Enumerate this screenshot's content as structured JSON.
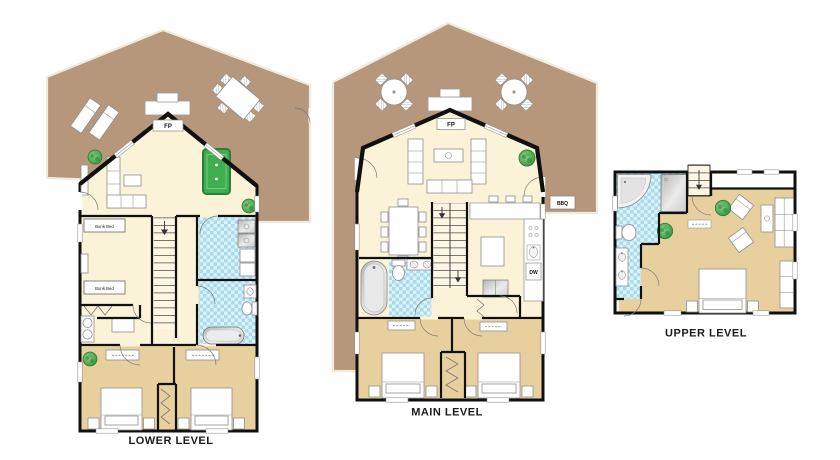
{
  "page": {
    "background": "#ffffff"
  },
  "colors": {
    "deck": "#b6977b",
    "interior": "#faf3d7",
    "bedroom_floor": "#e8cf9e",
    "tile_light": "#ddf1f8",
    "tile_dark": "#a8dbec",
    "wall": "#101010",
    "pool_table": "#3fae4f",
    "plant": "#3f9e42"
  },
  "levels": {
    "lower": {
      "caption": "LOWER LEVEL",
      "labels": {
        "fireplace": "FP",
        "bunk_bed_top": "Bunk Bed",
        "bunk_bed_bottom": "Bunk Bed"
      }
    },
    "main": {
      "caption": "MAIN LEVEL",
      "labels": {
        "fireplace": "FP",
        "bbq": "BBQ",
        "dishwasher": "DW"
      }
    },
    "upper": {
      "caption": "UPPER LEVEL"
    }
  }
}
